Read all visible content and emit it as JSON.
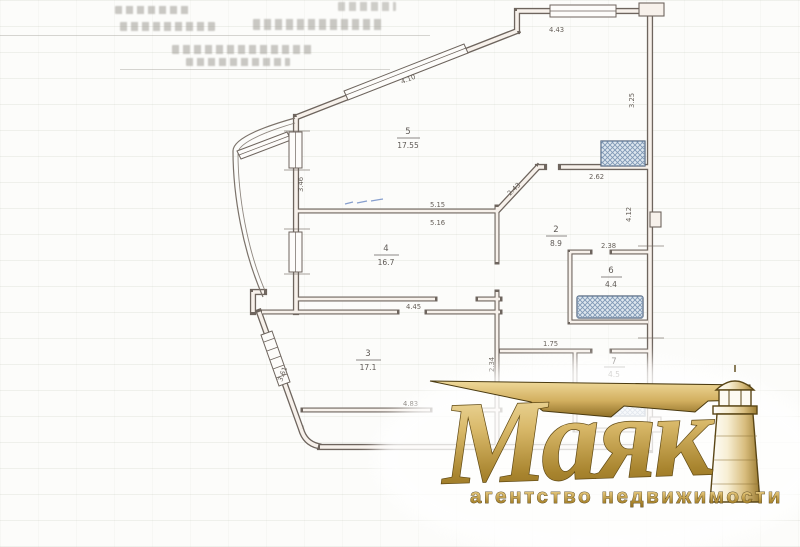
{
  "watermark": {
    "brand": "Маяк",
    "tagline": "агентство недвижимости",
    "gold": "#c9a24b",
    "gold_dark": "#6d520f"
  },
  "plan": {
    "colors": {
      "wall": "#6e655e",
      "fixture_fill": "#dde6ee",
      "fixture_line": "#53647c",
      "blue_ink": "#5577bb"
    },
    "rooms": [
      {
        "number": "5",
        "area": "17.55"
      },
      {
        "number": "4",
        "area": "16.7"
      },
      {
        "number": "3",
        "area": "17.1"
      },
      {
        "number": "2",
        "area": "8.9"
      },
      {
        "number": "6",
        "area": "4.4"
      },
      {
        "number": "7",
        "area": "4.5"
      }
    ],
    "dimensions": [
      {
        "text": "4.43"
      },
      {
        "text": "4.10"
      },
      {
        "text": "3.46"
      },
      {
        "text": "3.61"
      },
      {
        "text": "5.15"
      },
      {
        "text": "5.16"
      },
      {
        "text": "4.45"
      },
      {
        "text": "4.83"
      },
      {
        "text": "2.62"
      },
      {
        "text": "2.38"
      },
      {
        "text": "2.43"
      },
      {
        "text": "2.34"
      },
      {
        "text": "4.12"
      },
      {
        "text": "1.75"
      },
      {
        "text": "3.25"
      }
    ]
  }
}
